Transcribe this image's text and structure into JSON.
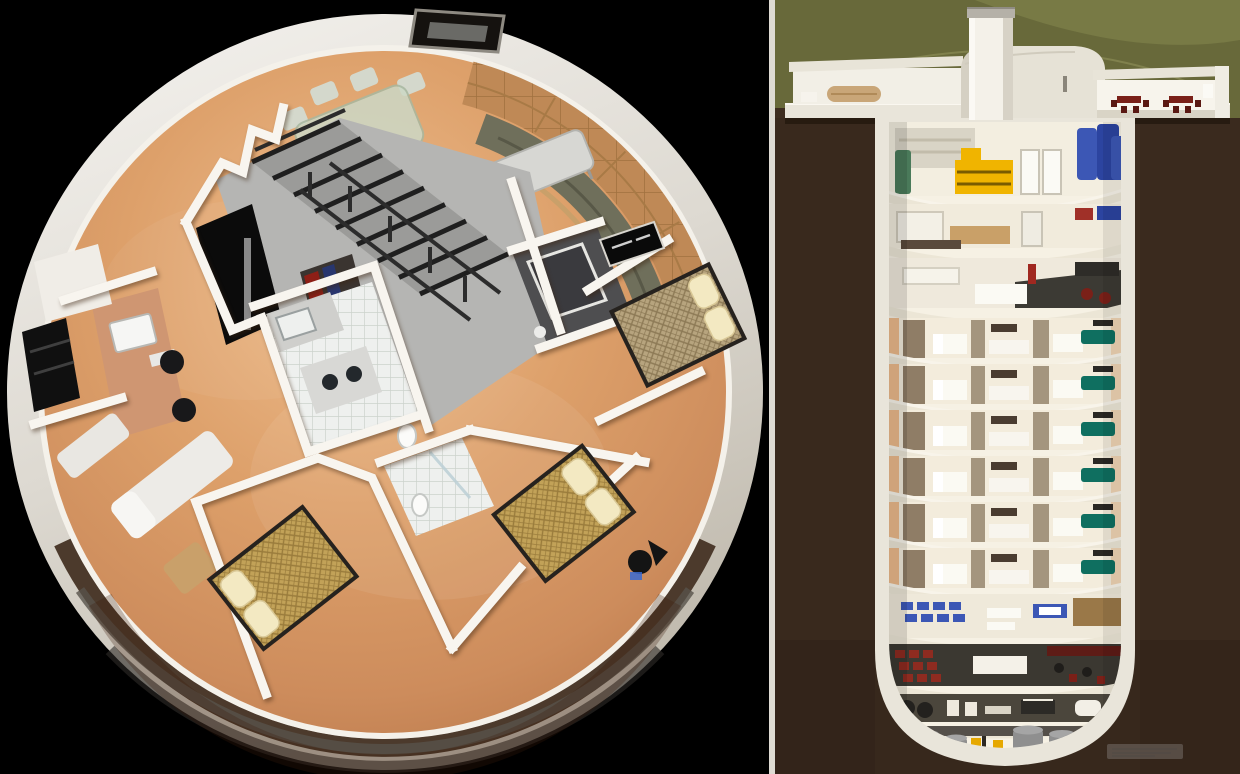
{
  "page": {
    "title": "Cutaway 3D renderings of an underground dome home and missile-silo condo tower",
    "text_visible": false
  },
  "palette": {
    "bg": "#000000",
    "divider": "#dedbd3",
    "wall": "#f8f5ef",
    "floor_edge": "#c9875a",
    "floor_mid": "#dda06a",
    "floor_hi": "#eebd8e",
    "rim_light": "#e5e1d9",
    "rim_dark": "#4c3a2c",
    "platform": "#b5b5b3",
    "stair": "#1f1f1f",
    "sofa": "#6f6f5b",
    "wood": "#bf8956",
    "quilt": "#c2a258",
    "pillow": "#f3e9c2",
    "tile": "#eef0ee",
    "desk": "#cf9672",
    "lounger": "#edebe7",
    "earth": "#3e2d20",
    "grass": "#68693a",
    "grass_hi": "#7c7e48",
    "shell": "#e9e5da",
    "slab": "#ece6d6",
    "interior": "#f6f1e4",
    "glow": "#e89a55",
    "taupe": "#8f7d66",
    "teal": "#0f6f60",
    "yellow": "#f0b400",
    "blue": "#3c57b5",
    "red": "#8e2b20",
    "maroon": "#7a2018",
    "tank": "#8f8f8f",
    "green_tank": "#4a7a5a",
    "watermark": "#b5b5b5"
  },
  "left_panel": {
    "name": "dome-floorplan",
    "aria": "Overhead cutaway rendering of a circular dome home: living room with curved sofa, dining table, kitchen, office desk, three bedrooms, bathrooms and central steel staircase",
    "rooms": [
      "living-room",
      "dining-area",
      "stair-loft",
      "kitchen",
      "office",
      "bathroom-dark",
      "bathroom-tiled",
      "bedroom-bottom-left",
      "bedroom-bottom-right",
      "bedroom-right",
      "lounge-area"
    ]
  },
  "right_panel": {
    "name": "silo-cross-section",
    "aria": "Cross-section cutaway rendering of a multi-level underground silo building beneath a grass dome with surface entry tower",
    "residential_floor_count": 6,
    "levels": [
      "surface-entry-dome",
      "utility-storage-level",
      "workshop-level",
      "common-area-level",
      "residential-condo-levels",
      "classroom-level",
      "theater-lounge-level",
      "gym-level",
      "mechanical-tank-level"
    ]
  },
  "watermark": {
    "present": true,
    "legible": false,
    "text": ""
  }
}
